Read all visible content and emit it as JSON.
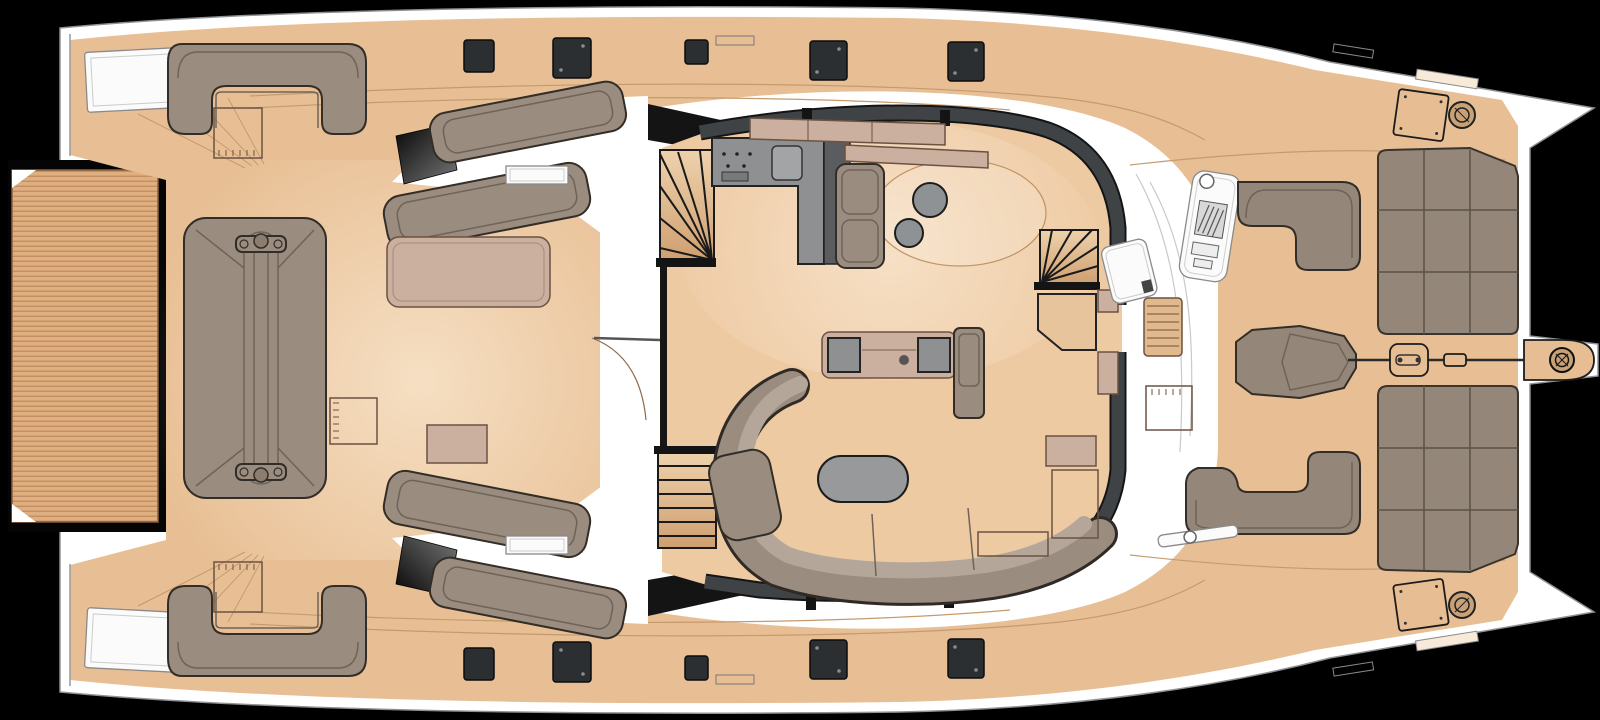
{
  "meta": {
    "type": "deck-plan",
    "subject": "catamaran-yacht-main-deck",
    "orientation": {
      "bow": "right",
      "stern": "left"
    }
  },
  "colors": {
    "background": "#000000",
    "hull": "#ffffff",
    "hullStroke": "#8e9296",
    "deck": "#e8bf94",
    "deckSeam": "#c59a6e",
    "deckEdge": "#a8messed",
    "teak": "#dfaf7f",
    "teakStripe": "#b9865a",
    "teakFrame": "#050505",
    "walkway": "#ffffff",
    "salonFloor": "#eecaa3",
    "wall": "#3f4346",
    "wallEdge": "#141414",
    "upholstery": "#9a8c7e",
    "upholsteryDeep": "#948678",
    "upholsteryEdge": "#332d27",
    "upholsteryLine": "#6f6359",
    "cushion": "#b4a799",
    "sunpad": "#948779",
    "sunpadEdge": "#3a342d",
    "sunpadLine": "#5a5248",
    "mauve": "#cbaf9f",
    "mauveEdge": "#6b5242",
    "counter": "#8f9092",
    "counterDark": "#5a5c5f",
    "counterEdge": "#232323",
    "steel": "#97999b",
    "pouf": "#8f9294",
    "dark": "#1c1c1c",
    "hatch": "#2c2f31",
    "hatchEdge": "#0c0c0c",
    "hatchDot": "#8a8d8f",
    "stair": "#e6c19a",
    "stairDeep": "#c89a6a",
    "stairLine": "#1a1a1a",
    "glassDark": "#0c0c0c",
    "glassLight": "#6e6e6e",
    "white": "#fbfbfb",
    "consoleEdge": "#8a8a8a",
    "lineThin": "#c9c9c9",
    "fitting": "#e7bd93",
    "winch": "#c9a176",
    "rug": "#c1925f"
  },
  "inventory": {
    "aft": [
      {
        "name": "teak-swim-platform",
        "count": 1
      },
      {
        "name": "stern-locker",
        "count": 2
      },
      {
        "name": "u-shaped-sofa",
        "count": 2
      },
      {
        "name": "square-side-table",
        "count": 3
      },
      {
        "name": "back-to-back-double-lounger",
        "count": 1
      },
      {
        "name": "daybed-cushion",
        "count": 2
      },
      {
        "name": "chaise-lounger",
        "count": 4
      },
      {
        "name": "privacy-glass-panel",
        "count": 2
      },
      {
        "name": "service-console",
        "count": 2
      }
    ],
    "salon": [
      {
        "name": "galley-l-counter",
        "count": 1
      },
      {
        "name": "sink",
        "count": 1
      },
      {
        "name": "cooktop",
        "count": 1
      },
      {
        "name": "tall-cabinet",
        "count": 1
      },
      {
        "name": "sideboard",
        "count": 2
      },
      {
        "name": "armchair",
        "count": 1
      },
      {
        "name": "round-pouf",
        "count": 2
      },
      {
        "name": "area-rug-oval",
        "count": 1
      },
      {
        "name": "media-console",
        "count": 1
      },
      {
        "name": "tv-cabinet",
        "count": 1
      },
      {
        "name": "curved-sofa",
        "count": 1
      },
      {
        "name": "oval-coffee-table",
        "count": 1
      },
      {
        "name": "fan-staircase",
        "count": 2
      },
      {
        "name": "straight-staircase",
        "count": 1
      },
      {
        "name": "entry-counter",
        "count": 1
      },
      {
        "name": "sliding-door",
        "count": 2
      }
    ],
    "foredeck": [
      {
        "name": "helm-console",
        "count": 1
      },
      {
        "name": "boarding-step-grate",
        "count": 1
      },
      {
        "name": "l-shaped-bench",
        "count": 2
      },
      {
        "name": "bow-double-recliner",
        "count": 1
      },
      {
        "name": "square-side-table",
        "count": 1
      },
      {
        "name": "sunpad-grid",
        "count": 2
      },
      {
        "name": "deck-hatch-bow",
        "count": 2
      },
      {
        "name": "winch",
        "count": 3
      },
      {
        "name": "anchor-bridle-line",
        "count": 1
      },
      {
        "name": "bowsprit-pod",
        "count": 1
      }
    ],
    "side_decks": [
      {
        "name": "deck-hatch",
        "count": 10
      },
      {
        "name": "grab-rail",
        "count": 2
      }
    ]
  }
}
